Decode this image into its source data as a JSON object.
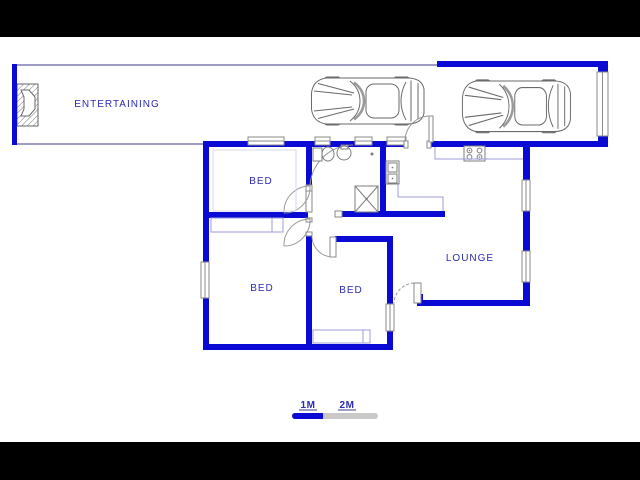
{
  "title": "Floor plan",
  "colors": {
    "wall": "#0a0ad4",
    "label": "#2b2bb4",
    "outline": "#3c3c88",
    "counter": "#9c9cd8",
    "fixture": "#7d7d7d",
    "jamb": "#8a8a8a",
    "arc": "#999999",
    "faint": "#d8d8ee",
    "scale_gray": "#c9c9c9",
    "scale_blue": "#0a0ad4",
    "letterbox": "#000000",
    "paper": "#ffffff"
  },
  "rooms": {
    "entertaining": "ENTERTAINING",
    "bed_top": "BED",
    "bed_left": "BED",
    "bed_middle": "BED",
    "lounge": "LOUNGE"
  },
  "scale_bar": {
    "label_1m": "1M",
    "label_2m": "2M"
  },
  "icons": {
    "car": "car-top-view-icon",
    "fireplace": "fireplace-icon",
    "toilet": "toilet-icon",
    "basin": "basin-icon",
    "shower": "shower-icon",
    "sink": "double-sink-icon",
    "stove": "stove-icon"
  }
}
